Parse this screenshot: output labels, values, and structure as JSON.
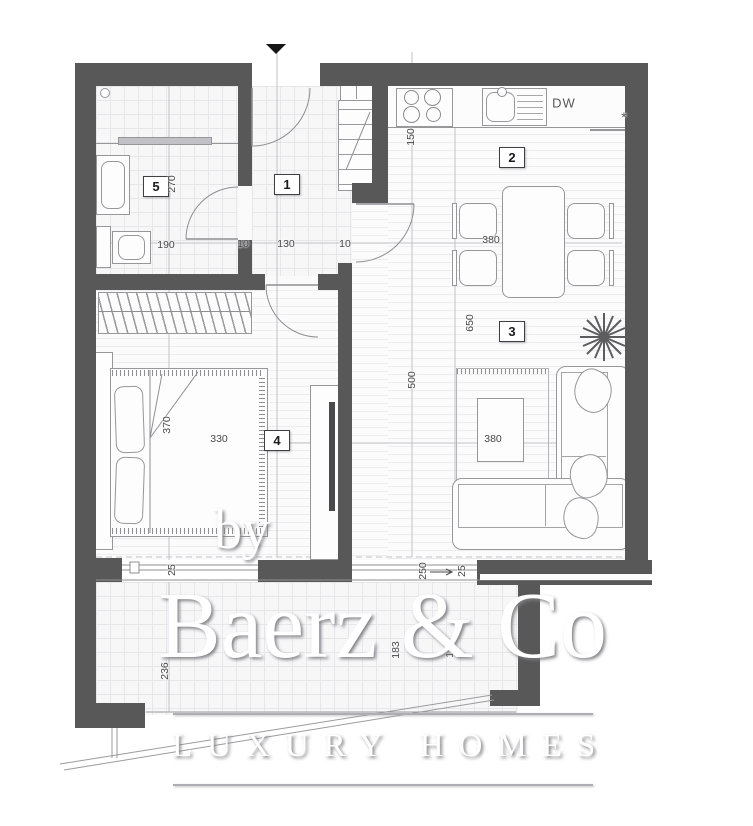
{
  "watermark": {
    "by": "by",
    "brand": "Baerz & Co",
    "tagline": "LUXURY HOMES"
  },
  "rooms": [
    {
      "number": "1",
      "name": "hallway"
    },
    {
      "number": "2",
      "name": "kitchen-dining"
    },
    {
      "number": "3",
      "name": "living-room"
    },
    {
      "number": "4",
      "name": "bedroom"
    },
    {
      "number": "5",
      "name": "bathroom"
    }
  ],
  "appliances": {
    "dishwasher": "DW",
    "counter_note": "*"
  },
  "dimensions": {
    "bathroom_depth": "270",
    "bathroom_width": "190",
    "hall_width": "130",
    "wall_thickness_a": "10",
    "wall_thickness_b": "10",
    "kitchen_counter_depth": "150",
    "dining_width": "380",
    "living_length": "650",
    "living_depth": "500",
    "bedroom_depth": "370",
    "bedroom_width": "330",
    "living_width": "380",
    "terrace_depth": "236",
    "terrace_dim_a": "183",
    "terrace_dim_b": "171",
    "opening_jamb_left": "25",
    "sliding_door_width": "250",
    "opening_jamb_right": "25"
  },
  "colors": {
    "wall": "#585858",
    "outline": "#97979a",
    "dim_text": "#48484a"
  }
}
